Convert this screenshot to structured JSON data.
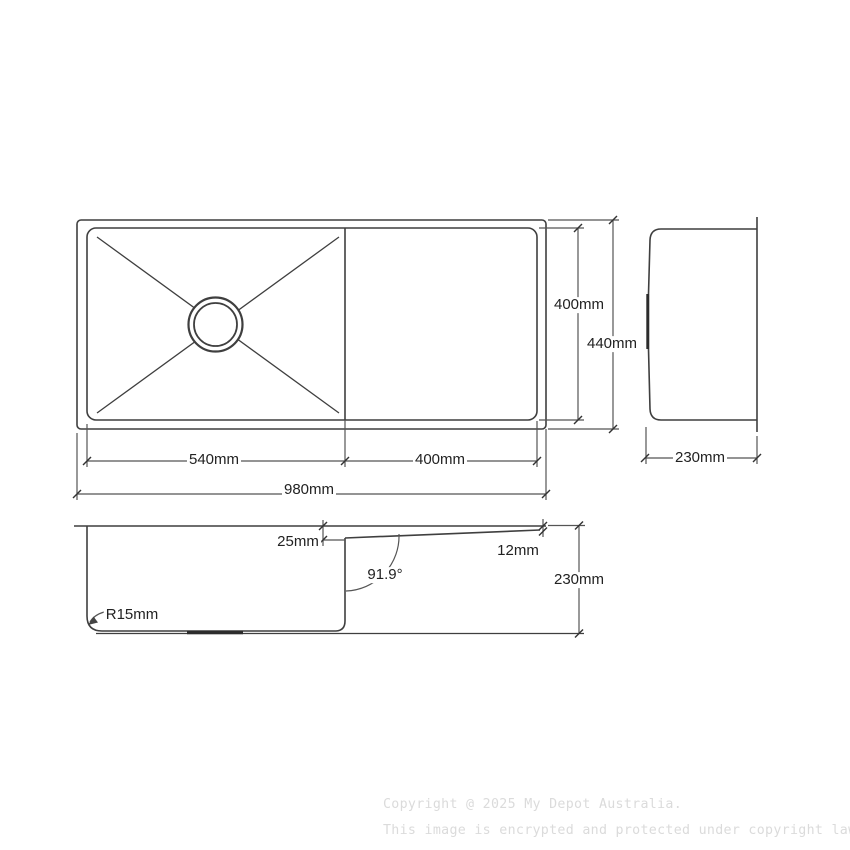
{
  "top_view": {
    "inner_width_label": "400mm",
    "outer_height_label": "440mm",
    "bowl_width_label": "540mm",
    "drainer_width_label": "400mm",
    "overall_width_label": "980mm"
  },
  "side_view": {
    "depth_label": "230mm"
  },
  "section_view": {
    "step_depth_label": "25mm",
    "edge_depth_label": "12mm",
    "wall_angle_label": "91.9°",
    "corner_radius_label": "R15mm",
    "overall_depth_label": "230mm"
  },
  "watermark": {
    "line1": "Copyright @ 2025 My Depot Australia.",
    "line2": "This image is encrypted and protected under copyright law."
  },
  "colors": {
    "object_line": "#3f3f3f",
    "dimension_line": "#555555",
    "text": "#222222",
    "watermark": "#dbdbdb",
    "background": "#ffffff"
  }
}
